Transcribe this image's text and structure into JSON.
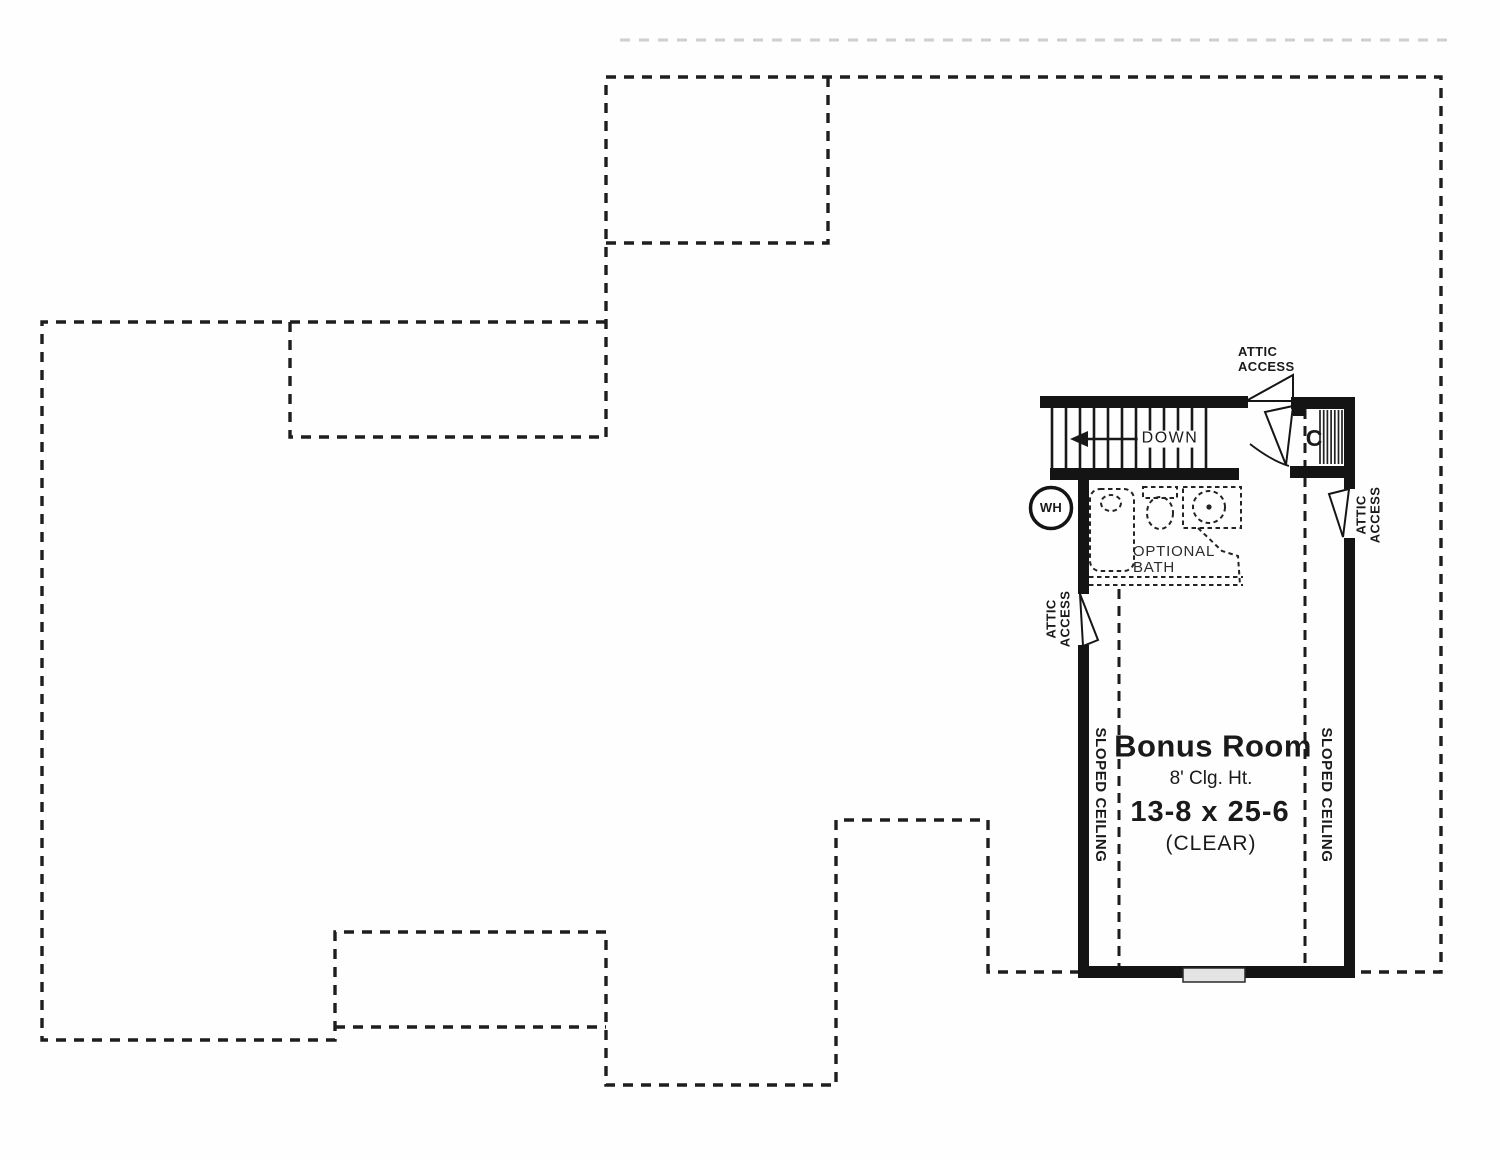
{
  "plan": {
    "room": {
      "title": "Bonus Room",
      "ceiling": "8' Clg. Ht.",
      "dimensions": "13-8 x 25-6",
      "clearance": "(CLEAR)"
    },
    "labels": {
      "sloped_ceiling": "SLOPED CEILING",
      "attic": "ATTIC",
      "access": "ACCESS",
      "down": "DOWN",
      "water_heater": "WH",
      "closet": "C",
      "optional": "OPTIONAL",
      "bath": "BATH"
    },
    "colors": {
      "wall": "#141414",
      "line": "#1e1e1e",
      "faint": "#cfcfcf",
      "window": "#e4e4e4",
      "text": "#1a1a1a"
    }
  }
}
